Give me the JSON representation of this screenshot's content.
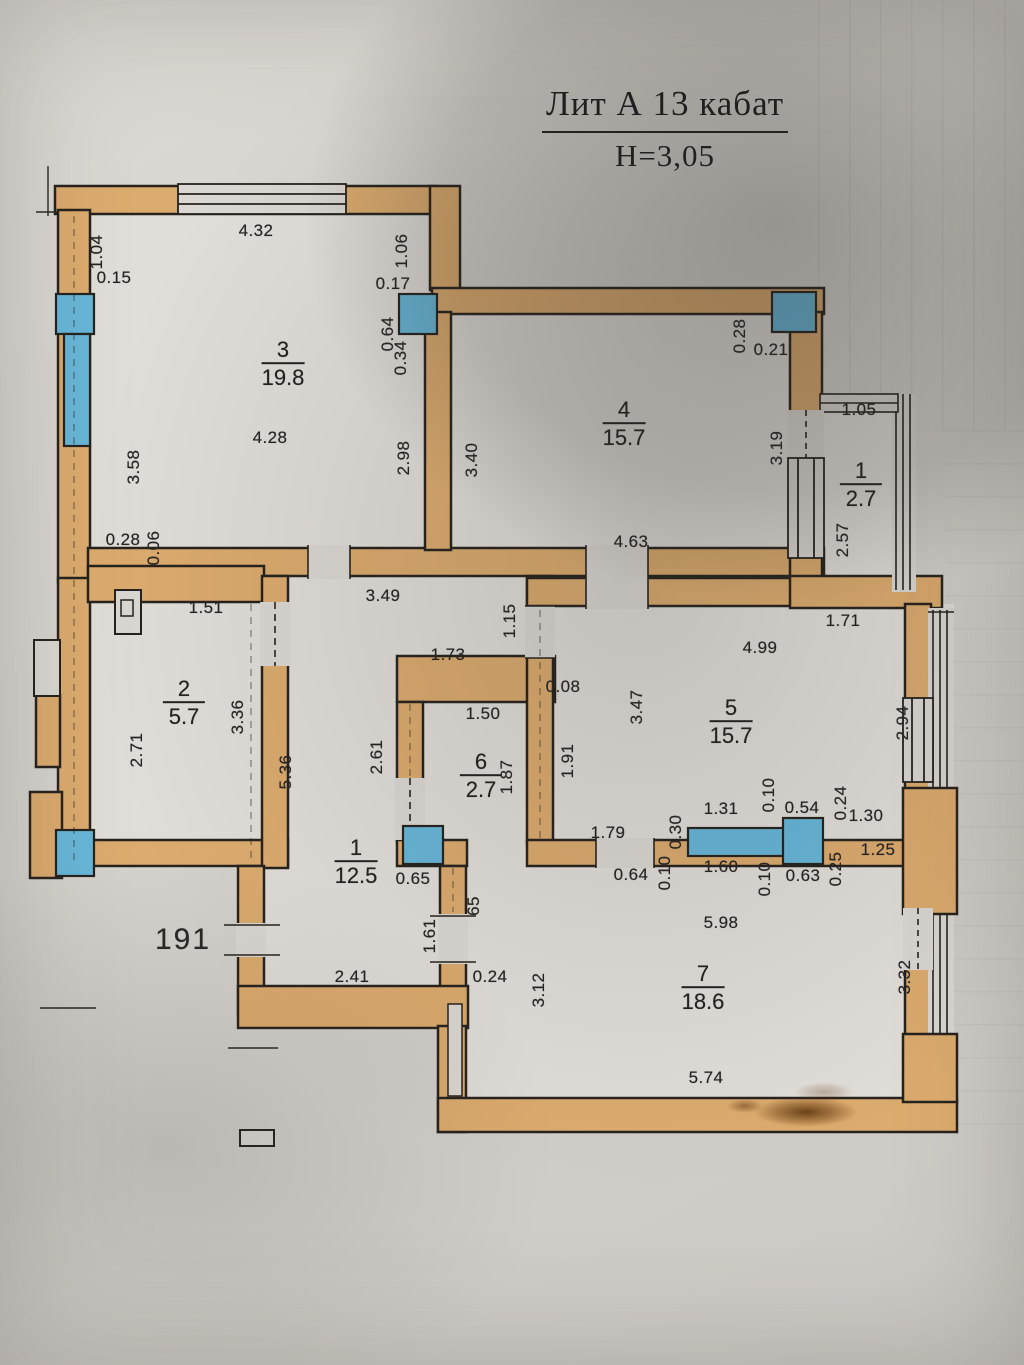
{
  "title": {
    "line1": "Лит А 13 кабат",
    "line2": "H=3,05"
  },
  "apartment_number": "191",
  "colors": {
    "wall": "#dcab6e",
    "window": "#67b6d8",
    "ink": "#26221d",
    "paper": "#dbd8d3",
    "room": "#e1ded9"
  },
  "plan": {
    "rooms": [
      {
        "number": "3",
        "area": "19.8",
        "x": 283,
        "y": 364
      },
      {
        "number": "4",
        "area": "15.7",
        "x": 624,
        "y": 424
      },
      {
        "number": "1",
        "area": "2.7",
        "x": 861,
        "y": 485
      },
      {
        "number": "2",
        "area": "5.7",
        "x": 184,
        "y": 703
      },
      {
        "number": "5",
        "area": "15.7",
        "x": 731,
        "y": 722
      },
      {
        "number": "6",
        "area": "2.7",
        "x": 481,
        "y": 776
      },
      {
        "number": "1",
        "area": "12.5",
        "x": 356,
        "y": 862
      },
      {
        "number": "7",
        "area": "18.6",
        "x": 703,
        "y": 988
      }
    ],
    "dimension_labels": [
      {
        "text": "4.32",
        "x": 256,
        "y": 231
      },
      {
        "text": "1.04",
        "x": 97,
        "y": 252,
        "r": 1
      },
      {
        "text": "0.15",
        "x": 114,
        "y": 278
      },
      {
        "text": "3.58",
        "x": 134,
        "y": 467,
        "r": 1
      },
      {
        "text": "4.28",
        "x": 270,
        "y": 438
      },
      {
        "text": "1.06",
        "x": 402,
        "y": 251,
        "r": 1
      },
      {
        "text": "0.17",
        "x": 393,
        "y": 284
      },
      {
        "text": "0.64",
        "x": 388,
        "y": 334,
        "r": 1
      },
      {
        "text": "0.34",
        "x": 401,
        "y": 358,
        "r": 1
      },
      {
        "text": "2.98",
        "x": 404,
        "y": 458,
        "r": 1
      },
      {
        "text": "3.40",
        "x": 472,
        "y": 460,
        "r": 1
      },
      {
        "text": "0.28",
        "x": 740,
        "y": 336,
        "r": 1
      },
      {
        "text": "0.21",
        "x": 771,
        "y": 350
      },
      {
        "text": "3.19",
        "x": 777,
        "y": 448,
        "r": 1
      },
      {
        "text": "4.63",
        "x": 631,
        "y": 542
      },
      {
        "text": "1.05",
        "x": 859,
        "y": 410
      },
      {
        "text": "2.57",
        "x": 843,
        "y": 540,
        "r": 1
      },
      {
        "text": "0.28",
        "x": 123,
        "y": 540
      },
      {
        "text": "0.06",
        "x": 154,
        "y": 548,
        "r": 1
      },
      {
        "text": "1.51",
        "x": 206,
        "y": 608
      },
      {
        "text": "3.49",
        "x": 383,
        "y": 596
      },
      {
        "text": "1.15",
        "x": 510,
        "y": 621,
        "r": 1
      },
      {
        "text": "1.73",
        "x": 448,
        "y": 655
      },
      {
        "text": "0.08",
        "x": 563,
        "y": 687
      },
      {
        "text": "1.50",
        "x": 483,
        "y": 714
      },
      {
        "text": "2.71",
        "x": 137,
        "y": 750,
        "r": 1
      },
      {
        "text": "3.36",
        "x": 238,
        "y": 717,
        "r": 1
      },
      {
        "text": "5.36",
        "x": 286,
        "y": 772,
        "r": 1
      },
      {
        "text": "2.61",
        "x": 377,
        "y": 757,
        "r": 1
      },
      {
        "text": "1.87",
        "x": 507,
        "y": 777,
        "r": 1
      },
      {
        "text": "1.91",
        "x": 568,
        "y": 761,
        "r": 1
      },
      {
        "text": "3.47",
        "x": 637,
        "y": 707,
        "r": 1
      },
      {
        "text": "4.99",
        "x": 760,
        "y": 648
      },
      {
        "text": "1.71",
        "x": 843,
        "y": 621
      },
      {
        "text": "2.94",
        "x": 903,
        "y": 723,
        "r": 1
      },
      {
        "text": "1.79",
        "x": 608,
        "y": 833
      },
      {
        "text": "0.30",
        "x": 676,
        "y": 832,
        "r": 1
      },
      {
        "text": "1.31",
        "x": 721,
        "y": 809
      },
      {
        "text": "0.10",
        "x": 769,
        "y": 795,
        "r": 1
      },
      {
        "text": "0.54",
        "x": 802,
        "y": 808
      },
      {
        "text": "0.24",
        "x": 841,
        "y": 803,
        "r": 1
      },
      {
        "text": "1.30",
        "x": 866,
        "y": 816
      },
      {
        "text": "0.25",
        "x": 836,
        "y": 869,
        "r": 1
      },
      {
        "text": "1.25",
        "x": 878,
        "y": 850
      },
      {
        "text": "0.64",
        "x": 631,
        "y": 875
      },
      {
        "text": "0.10",
        "x": 665,
        "y": 873,
        "r": 1
      },
      {
        "text": "1.60",
        "x": 721,
        "y": 867
      },
      {
        "text": "0.10",
        "x": 765,
        "y": 879,
        "r": 1
      },
      {
        "text": "0.63",
        "x": 803,
        "y": 876
      },
      {
        "text": "0.65",
        "x": 413,
        "y": 879
      },
      {
        "text": "65",
        "x": 474,
        "y": 906,
        "r": 1
      },
      {
        "text": "1.61",
        "x": 430,
        "y": 936,
        "r": 1
      },
      {
        "text": "0.24",
        "x": 490,
        "y": 977
      },
      {
        "text": "2.41",
        "x": 352,
        "y": 977
      },
      {
        "text": "5.98",
        "x": 721,
        "y": 923
      },
      {
        "text": "3.12",
        "x": 539,
        "y": 990,
        "r": 1
      },
      {
        "text": "3.32",
        "x": 905,
        "y": 977,
        "r": 1
      },
      {
        "text": "5.74",
        "x": 706,
        "y": 1078
      }
    ]
  }
}
